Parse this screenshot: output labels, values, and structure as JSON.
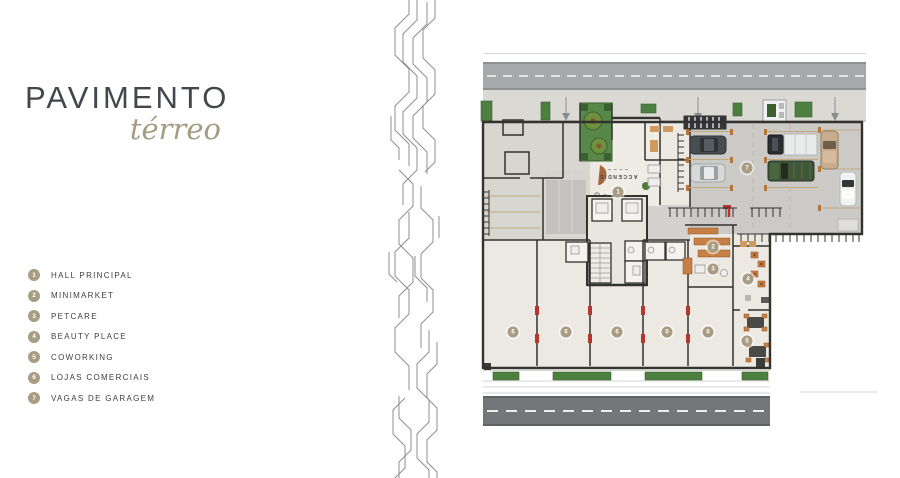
{
  "header": {
    "title": "PAVIMENTO",
    "subtitle": "térreo"
  },
  "legend": {
    "items": [
      {
        "number": "1",
        "label": "HALL PRINCIPAL"
      },
      {
        "number": "2",
        "label": "MINIMARKET"
      },
      {
        "number": "3",
        "label": "PETCARE"
      },
      {
        "number": "4",
        "label": "BEAUTY PLACE"
      },
      {
        "number": "5",
        "label": "COWORKING"
      },
      {
        "number": "6",
        "label": "LOJAS COMERCIAIS"
      },
      {
        "number": "7",
        "label": "VAGAS DE GARAGEM"
      }
    ]
  },
  "plan": {
    "building_label": "ACCENDIS",
    "badges": [
      {
        "n": "1"
      },
      {
        "n": "2"
      },
      {
        "n": "3"
      },
      {
        "n": "4"
      },
      {
        "n": "5"
      },
      {
        "n": "6"
      },
      {
        "n": "6"
      },
      {
        "n": "6"
      },
      {
        "n": "6"
      },
      {
        "n": "6"
      },
      {
        "n": "7"
      }
    ]
  },
  "theme": {
    "accent": "#a89c82",
    "title_color": "#43464a",
    "script_color": "#a59b80",
    "label_color": "#3f3f3f",
    "wall": "#32322e",
    "road": "#a6a9ab",
    "road_dark": "#747779",
    "sidewalk": "#dbd9d4",
    "floor": "#ece9e2",
    "floor_gray": "#d8d6d1",
    "garage_floor": "#cbcac7",
    "green": "#4d8040",
    "green_dark": "#3a612f",
    "orange": "#c67f44",
    "red": "#b4362c",
    "pattern_line": "#8f8f8f"
  }
}
